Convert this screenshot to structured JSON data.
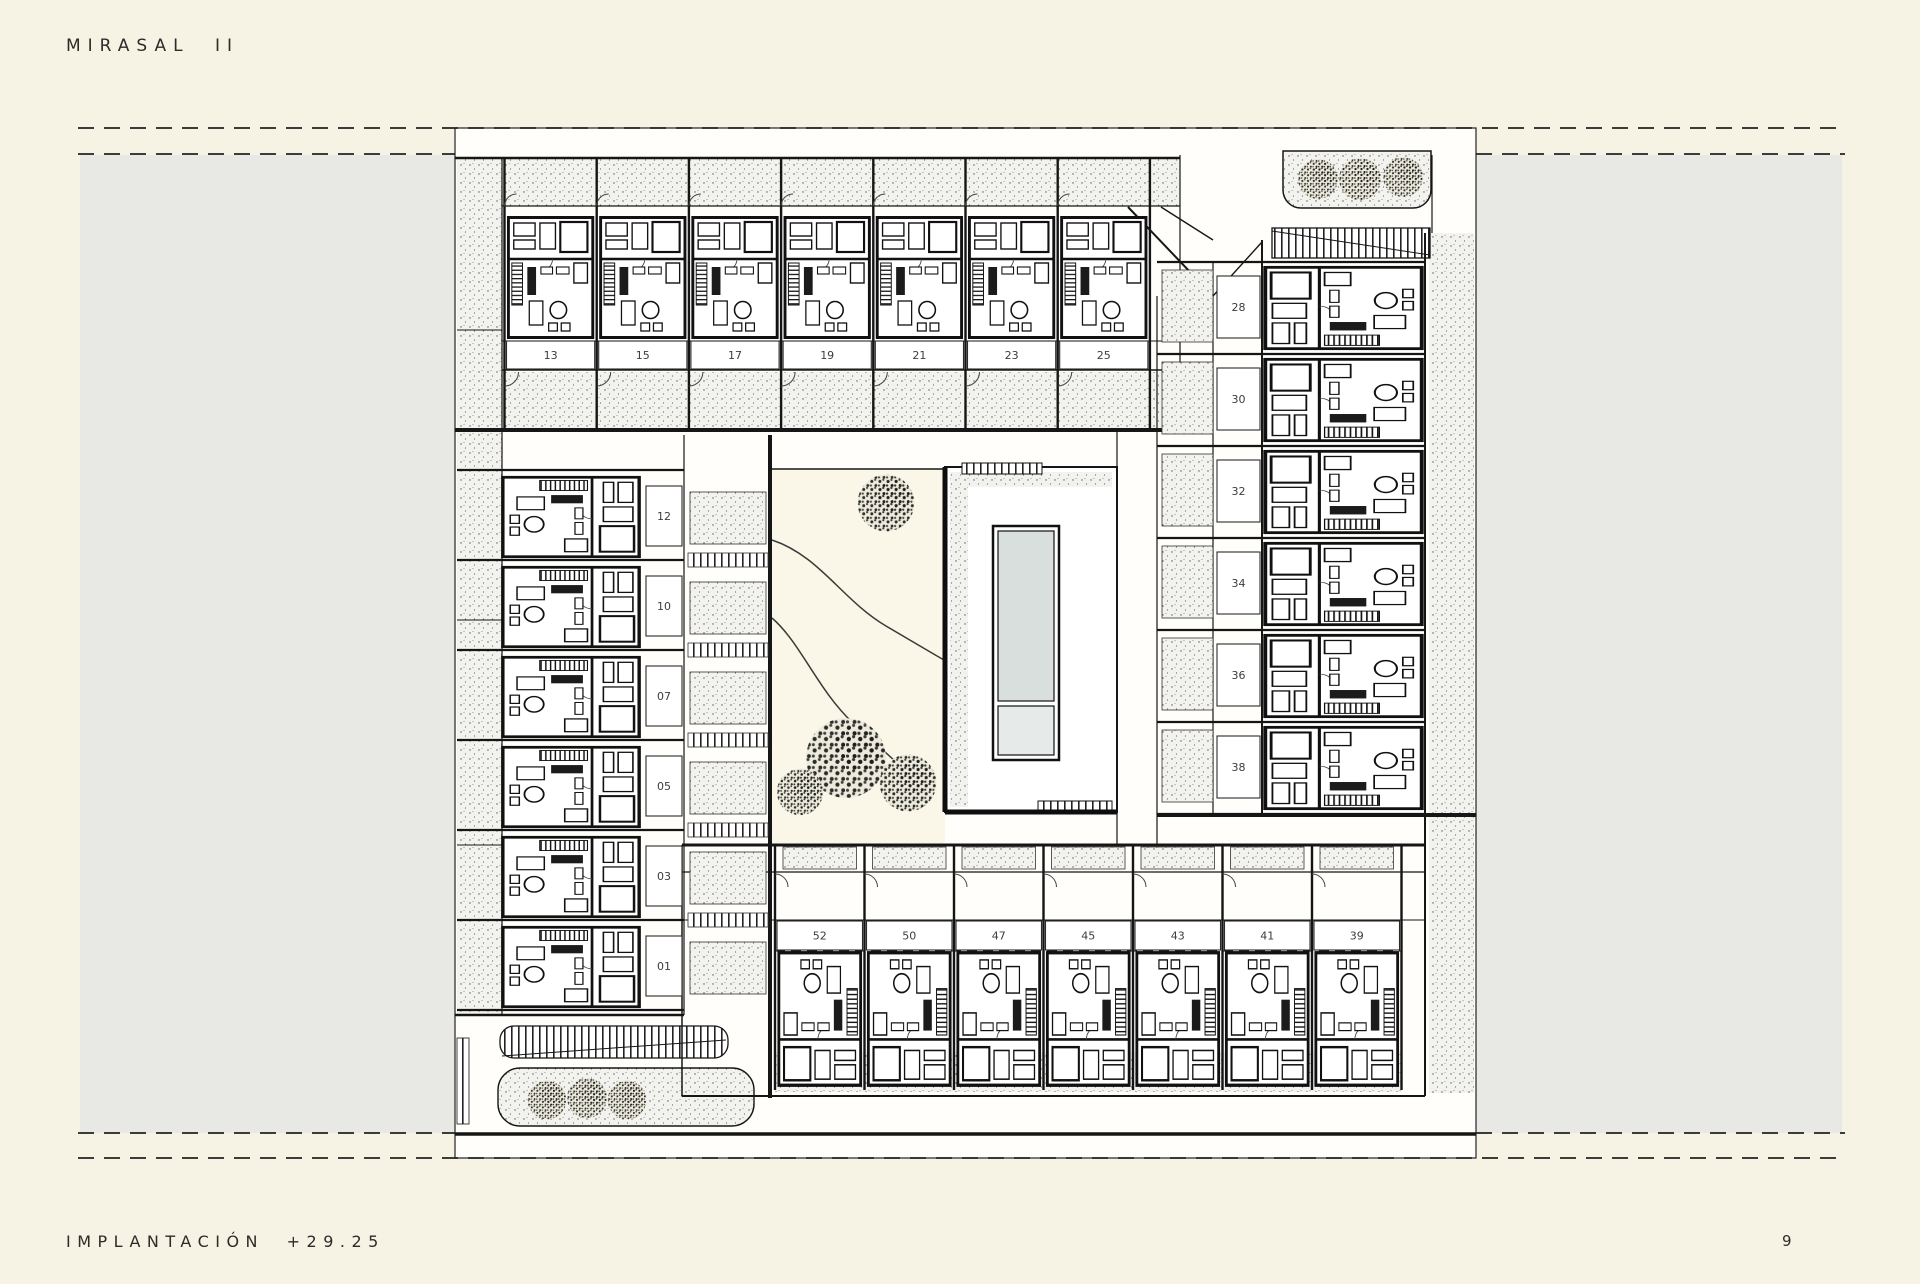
{
  "header": {
    "title": "MIRASAL II"
  },
  "footer": {
    "caption": "IMPLANTACIÓN +29.25",
    "page_number": "9"
  },
  "plan": {
    "top_row": {
      "unit_labels": [
        "13",
        "15",
        "17",
        "19",
        "21",
        "23",
        "25"
      ]
    },
    "bottom_row": {
      "unit_labels": [
        "52",
        "50",
        "47",
        "45",
        "43",
        "41",
        "39"
      ]
    },
    "left_column": {
      "unit_labels": [
        "12",
        "10",
        "07",
        "05",
        "03",
        "01"
      ]
    },
    "right_column": {
      "unit_labels": [
        "28",
        "30",
        "32",
        "34",
        "36",
        "38"
      ]
    }
  },
  "colors": {
    "paper": "#f6f3e4",
    "side_band": "#e8e8e5",
    "ink": "#1f1f1f",
    "pool_water": "#d9dfdd",
    "pool_shallow": "#e6eae8",
    "garden": "#fbf7e8",
    "stipple_bg": "#f2f2ee"
  }
}
